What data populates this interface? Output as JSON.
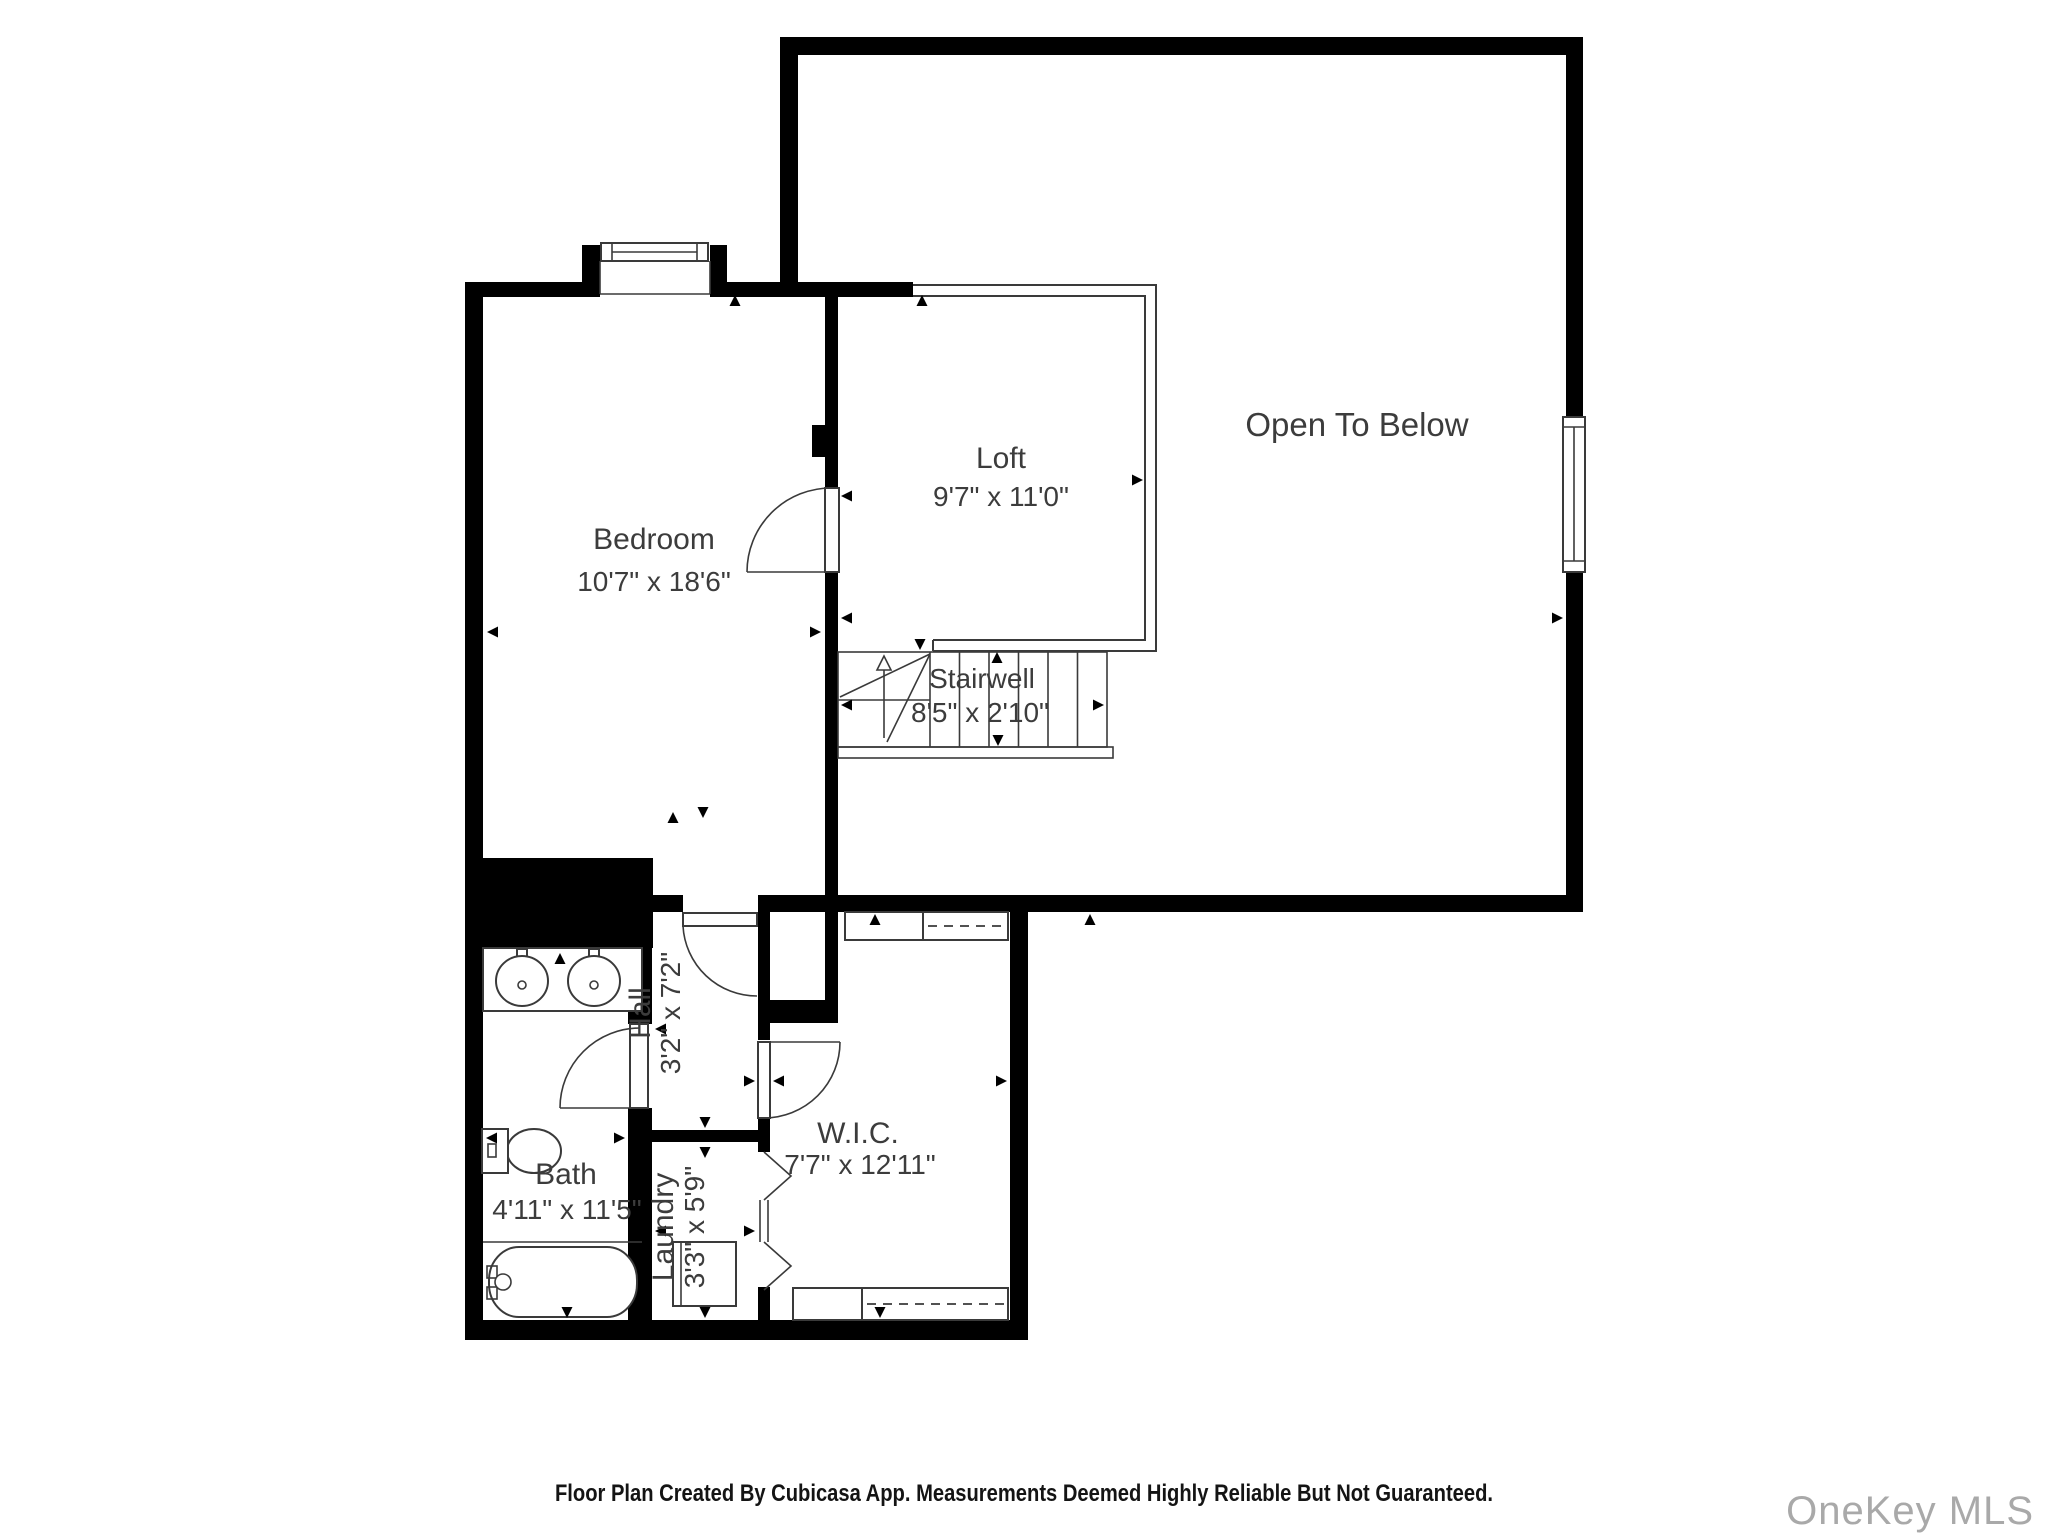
{
  "colors": {
    "wall": "#000000",
    "line": "#3a3a3a",
    "label_text": "#3c3c3c",
    "watermark": "#a9a9a9",
    "background": "#ffffff"
  },
  "icons": {
    "dimension_arrow": "small filled triangle",
    "stair_direction_arrow": "open triangle with shaft",
    "door_swing": "quarter-circle arc",
    "bifold_door": "chevron zigzag",
    "closet_rod": "dashed line"
  },
  "rooms": {
    "bedroom": {
      "name": "Bedroom",
      "dimensions": "10'7\" x 18'6\""
    },
    "loft": {
      "name": "Loft",
      "dimensions": "9'7\" x 11'0\""
    },
    "open_to_below": {
      "name": "Open To Below"
    },
    "stairwell": {
      "name": "Stairwell",
      "dimensions": "8'5\" x 2'10\""
    },
    "hall": {
      "name": "Hall",
      "dimensions": "3'2\" x 7'2\""
    },
    "wic": {
      "name": "W.I.C.",
      "dimensions": "7'7\" x 12'11\""
    },
    "bath": {
      "name": "Bath",
      "dimensions": "4'11\" x 11'5\""
    },
    "laundry": {
      "name": "Laundry",
      "dimensions": "3'3\" x 5'9\""
    }
  },
  "footer": {
    "text": "Floor Plan Created By Cubicasa App. Measurements Deemed Highly Reliable But Not Guaranteed."
  },
  "watermark": {
    "text": "OneKey MLS"
  }
}
